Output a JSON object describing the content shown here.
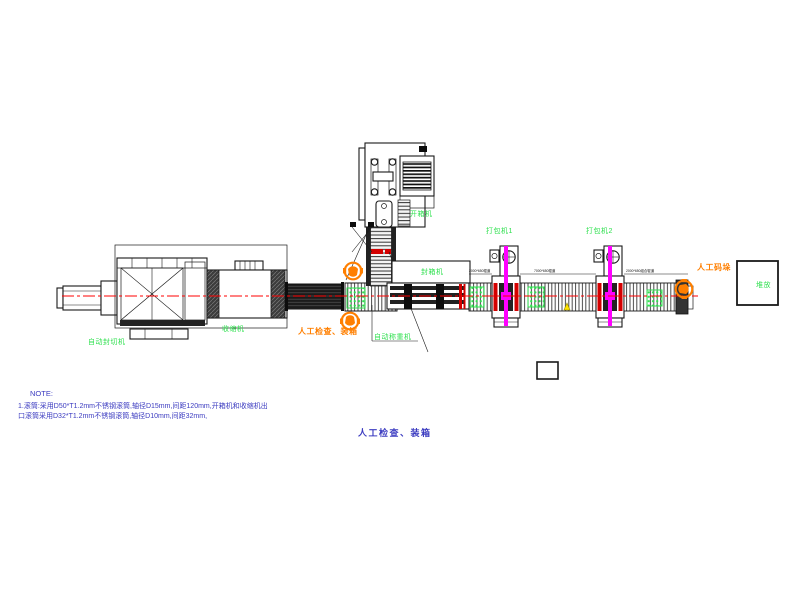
{
  "labels": {
    "auto_seal_cut_machine": "自动封切机",
    "shrink_machine": "收缩机",
    "case_erector": "开箱机",
    "case_sealer": "封箱机",
    "checkweigher": "自动称重机",
    "manual_check_pack": "人工检查、装箱",
    "strapper_1": "打包机1",
    "strapper_2": "打包机2",
    "manual_palletizing": "人工码垛",
    "stacking_area": "堆放",
    "manual_check_pack_note": "人工检查、装箱"
  },
  "dimensions": {
    "segment_1": "2000*650辊道",
    "segment_2": "7000*650辊道",
    "segment_3": "2000*650组合辊道"
  },
  "note": {
    "heading": "NOTE:",
    "line_1": "1.滚筒:采用D50*T1.2mm不锈钢滚筒,轴径D15mm,间距120mm,开箱机和收缩机出",
    "line_2": "口滚筒采用D32*T1.2mm不锈钢滚筒,轴径D10mm,间距32mm,"
  },
  "colors": {
    "machine_label_green": "#2ee04e",
    "operator_orange": "#ff7f00",
    "note_blue": "#3b3bc0",
    "centerline_red": "#ff0000",
    "strap_magenta": "#ff00ff"
  }
}
